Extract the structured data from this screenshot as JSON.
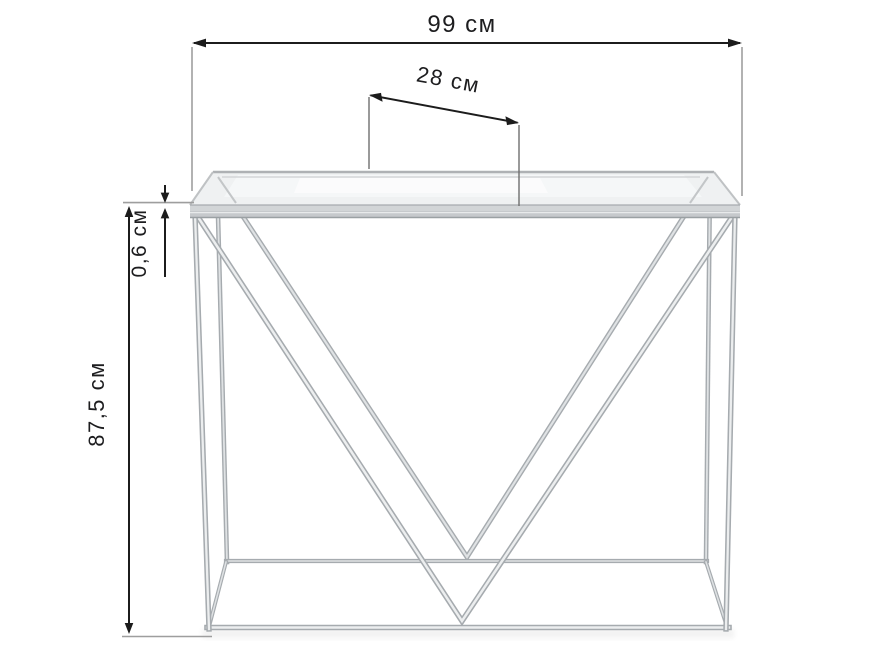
{
  "page": {
    "background": "#ffffff",
    "kind": "furniture dimension drawing",
    "subject": "glass console table with chrome double-V frame"
  },
  "dimensions": {
    "width": {
      "label": "99 см",
      "value": "99",
      "unit": "см",
      "orientation": "horizontal-top"
    },
    "depth": {
      "label": "28 см",
      "value": "28",
      "unit": "см",
      "orientation": "slanted-top"
    },
    "glass_thickness": {
      "label": "0,6 см",
      "value": "0,6",
      "unit": "см",
      "orientation": "vertical-left"
    },
    "height": {
      "label": "87,5 см",
      "value": "87,5",
      "unit": "см",
      "orientation": "vertical-left"
    }
  },
  "colors": {
    "dimension_line": "#1c1c1c",
    "extension_line": "#9e9e9e",
    "label_text": "#1d1d1f",
    "chrome_edge": "#a6abaf",
    "chrome_core": "#dfe2e4",
    "glass_fill": "#eff1f2",
    "glass_edge": "#aeb1b4",
    "background": "#ffffff"
  }
}
